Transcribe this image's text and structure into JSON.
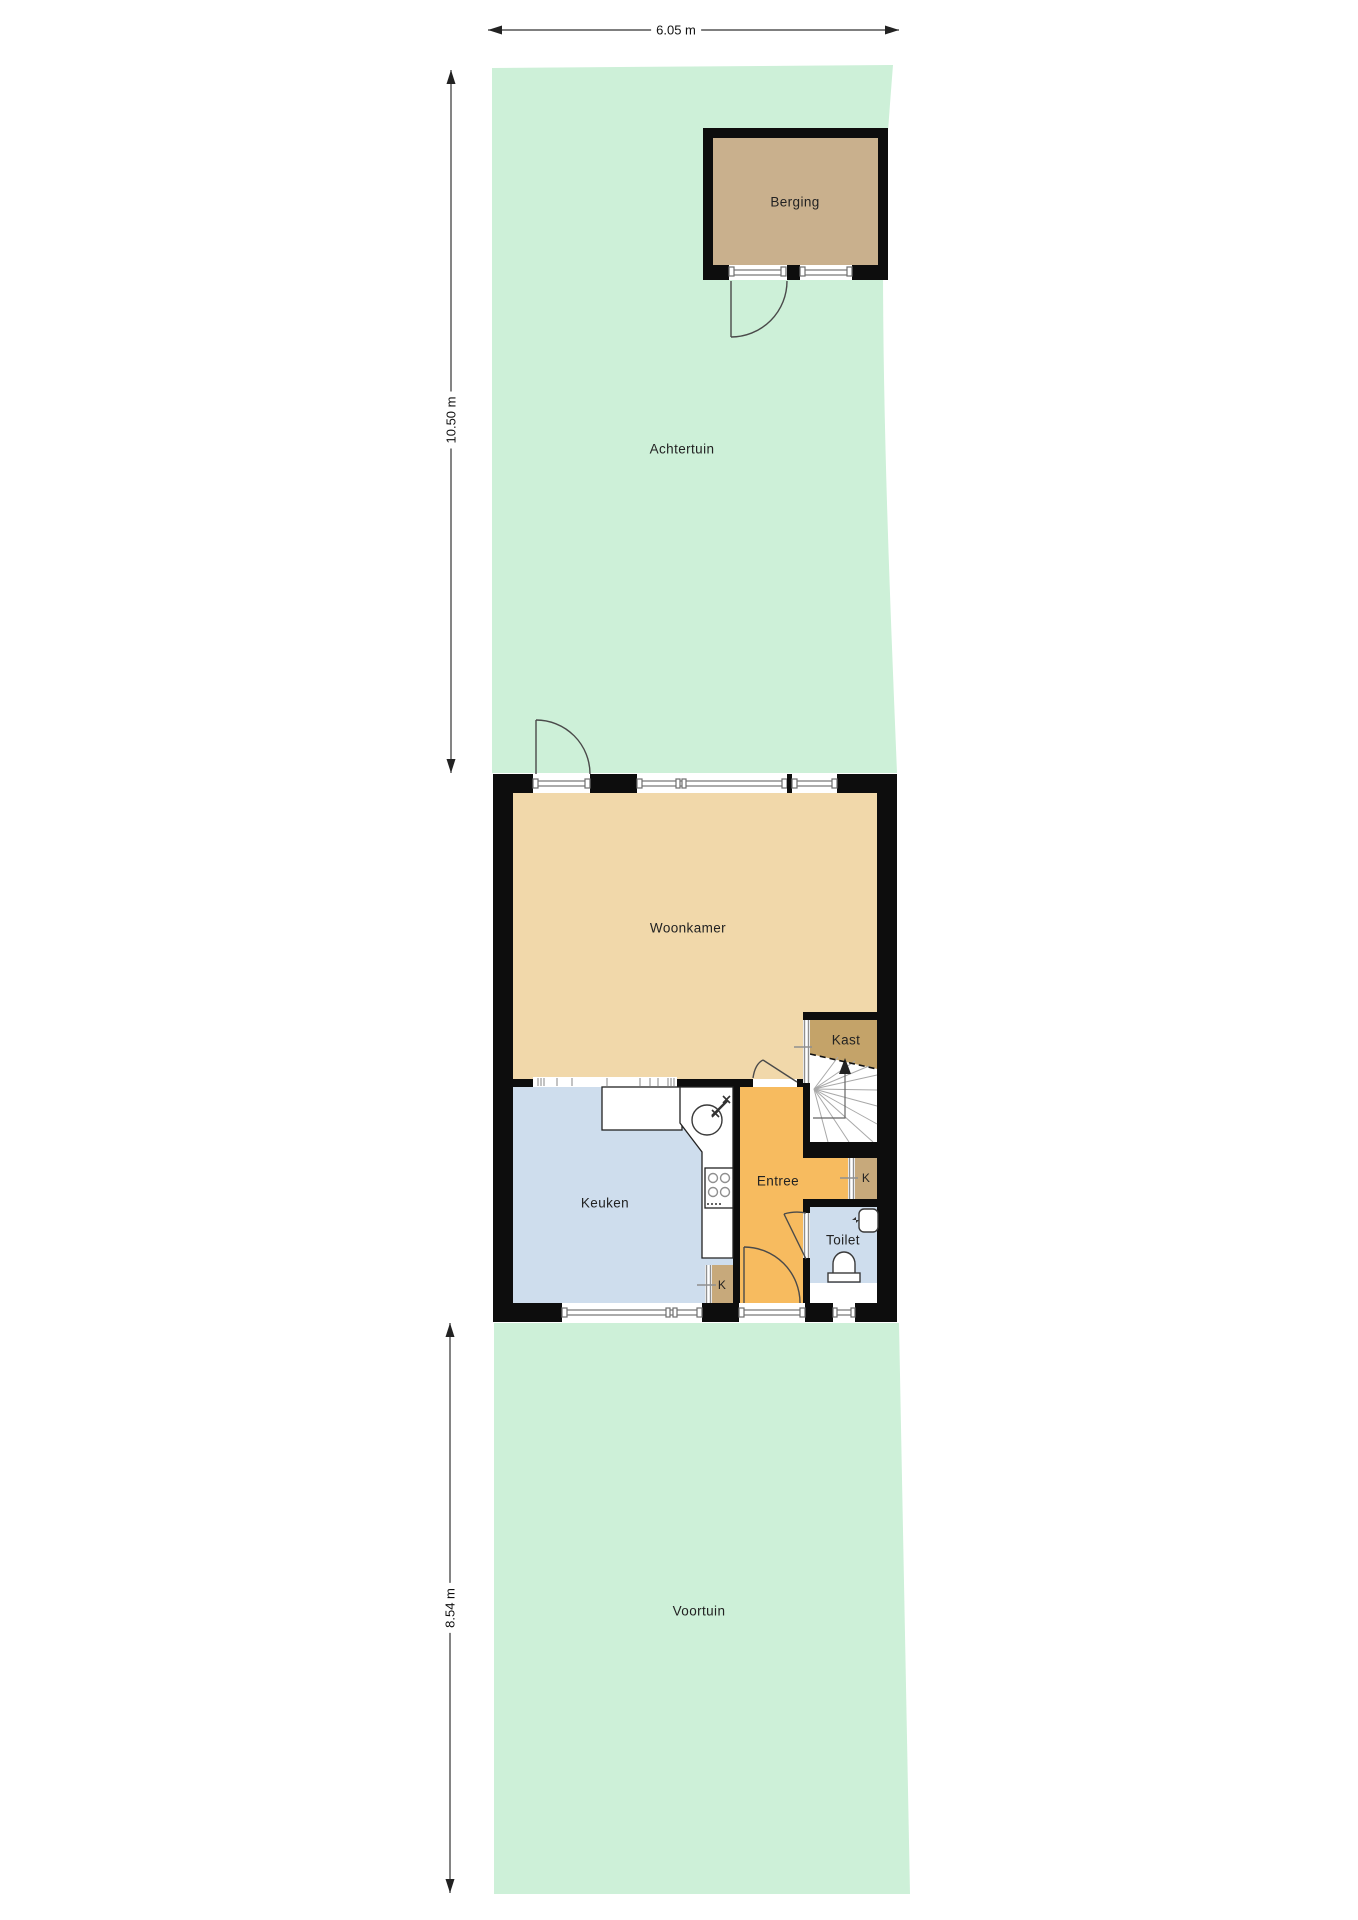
{
  "plan": {
    "type": "floorplan-ground-floor-with-plot",
    "rooms": {
      "berging": "Berging",
      "achtertuin": "Achtertuin",
      "woonkamer": "Woonkamer",
      "kast": "Kast",
      "keuken": "Keuken",
      "entree": "Entree",
      "toilet": "Toilet",
      "voortuin": "Voortuin"
    },
    "meter_labels": {
      "kitchen_meter": "K",
      "hall_meter": "K"
    },
    "dimensions": {
      "plot_width": "6.05 m",
      "back_garden_depth": "10.50 m",
      "front_garden_depth": "8.54 m"
    }
  },
  "colors": {
    "garden": "#cdf0d8",
    "shed": "#c9b08d",
    "living": "#f1d8aa",
    "closet": "#c4a369",
    "kitchen": "#cedded",
    "hall": "#f7bb5f",
    "meter": "#c7a97b",
    "wall": "#0d0d0d",
    "frame": "#8f8f8f"
  }
}
